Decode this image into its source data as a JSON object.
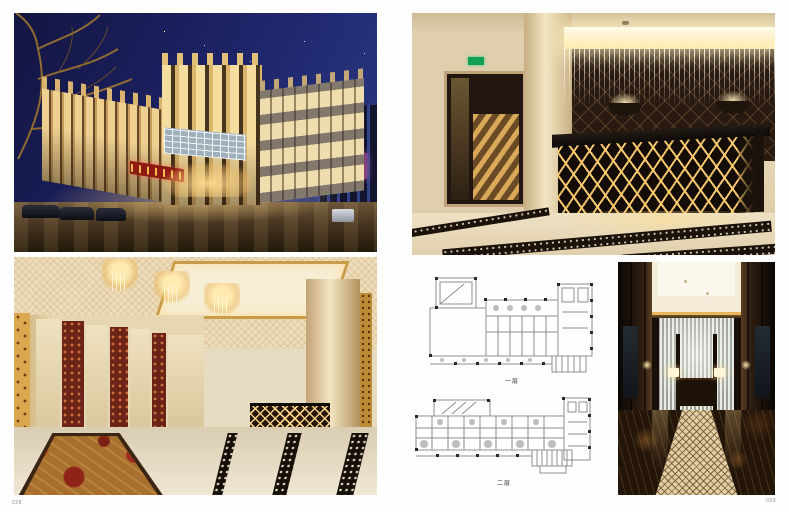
{
  "page": {
    "left_number": "028",
    "right_number": "029"
  },
  "plans": {
    "first_floor_caption": "一层",
    "second_floor_caption": "二层"
  },
  "palette": {
    "night_sky_blue": "#1c2264",
    "facade_gold": "#efd091",
    "sign_red": "#8e1a13",
    "lattice_glow_gold": "#ffd98a",
    "dark_wood": "#2e1d11",
    "marble_cream": "#e7dcc2",
    "plan_line_grey": "#8f8f8f"
  }
}
